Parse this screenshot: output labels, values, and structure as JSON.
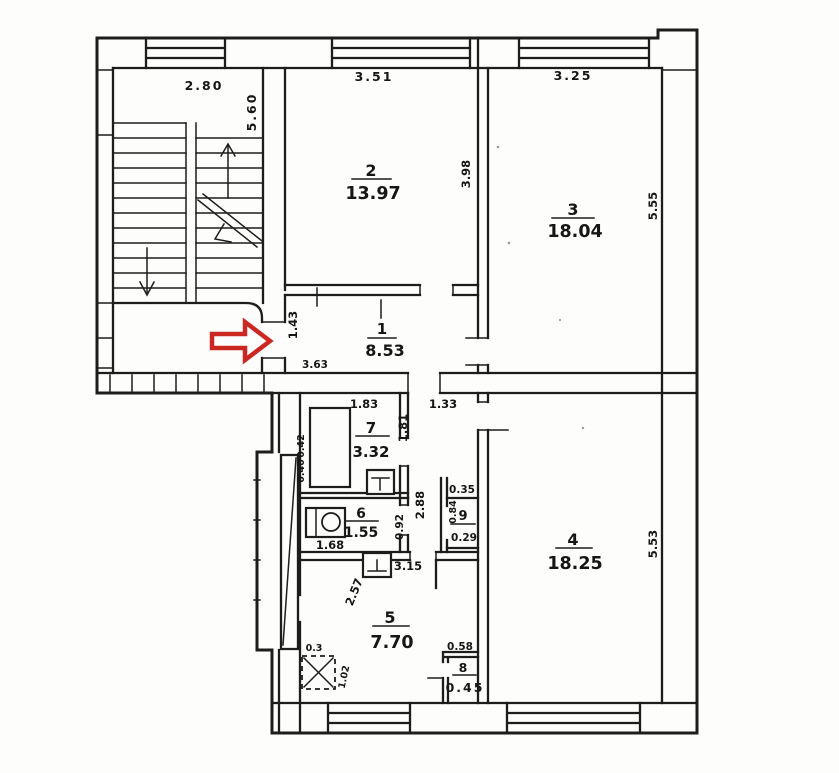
{
  "drawing": {
    "type": "apartment-floor-plan",
    "ink_color": "#1d1d1d",
    "paper_color": "#fdfdfb",
    "arrow_color": "#cb2823"
  },
  "rooms": {
    "r1": {
      "num": "1",
      "area": "8.53"
    },
    "r2": {
      "num": "2",
      "area": "13.97"
    },
    "r3": {
      "num": "3",
      "area": "18.04"
    },
    "r4": {
      "num": "4",
      "area": "18.25"
    },
    "r5": {
      "num": "5",
      "area": "7.70"
    },
    "r6": {
      "num": "6",
      "area": "1.55"
    },
    "r7": {
      "num": "7",
      "area": "3.32"
    },
    "r8": {
      "num": "8",
      "area": "0.45"
    },
    "r9": {
      "num": "9",
      "area": "0.29"
    }
  },
  "labels": {
    "stair_w": "2.80",
    "stair_h": "5.60",
    "r2_w": "3.51",
    "r2_h": "3.98",
    "r3_w": "3.25",
    "r3_h": "5.55",
    "r1_h": "1.43",
    "r1_w": "3.63",
    "r7_w": "1.83",
    "r7_h": "1.81",
    "hall_w": "1.33",
    "niche_top": "0.42",
    "niche_bottom": "0.40",
    "corridor_h": "2.88",
    "r6_w": "1.68",
    "r6_h": "0.92",
    "r9_w": "0.35",
    "r9_h": "0.84",
    "r4_h": "5.53",
    "r5_w": "3.15",
    "r5_h": "2.57",
    "stove_side": "0.3",
    "stove_len": "1.02",
    "r8_w": "0.58"
  }
}
